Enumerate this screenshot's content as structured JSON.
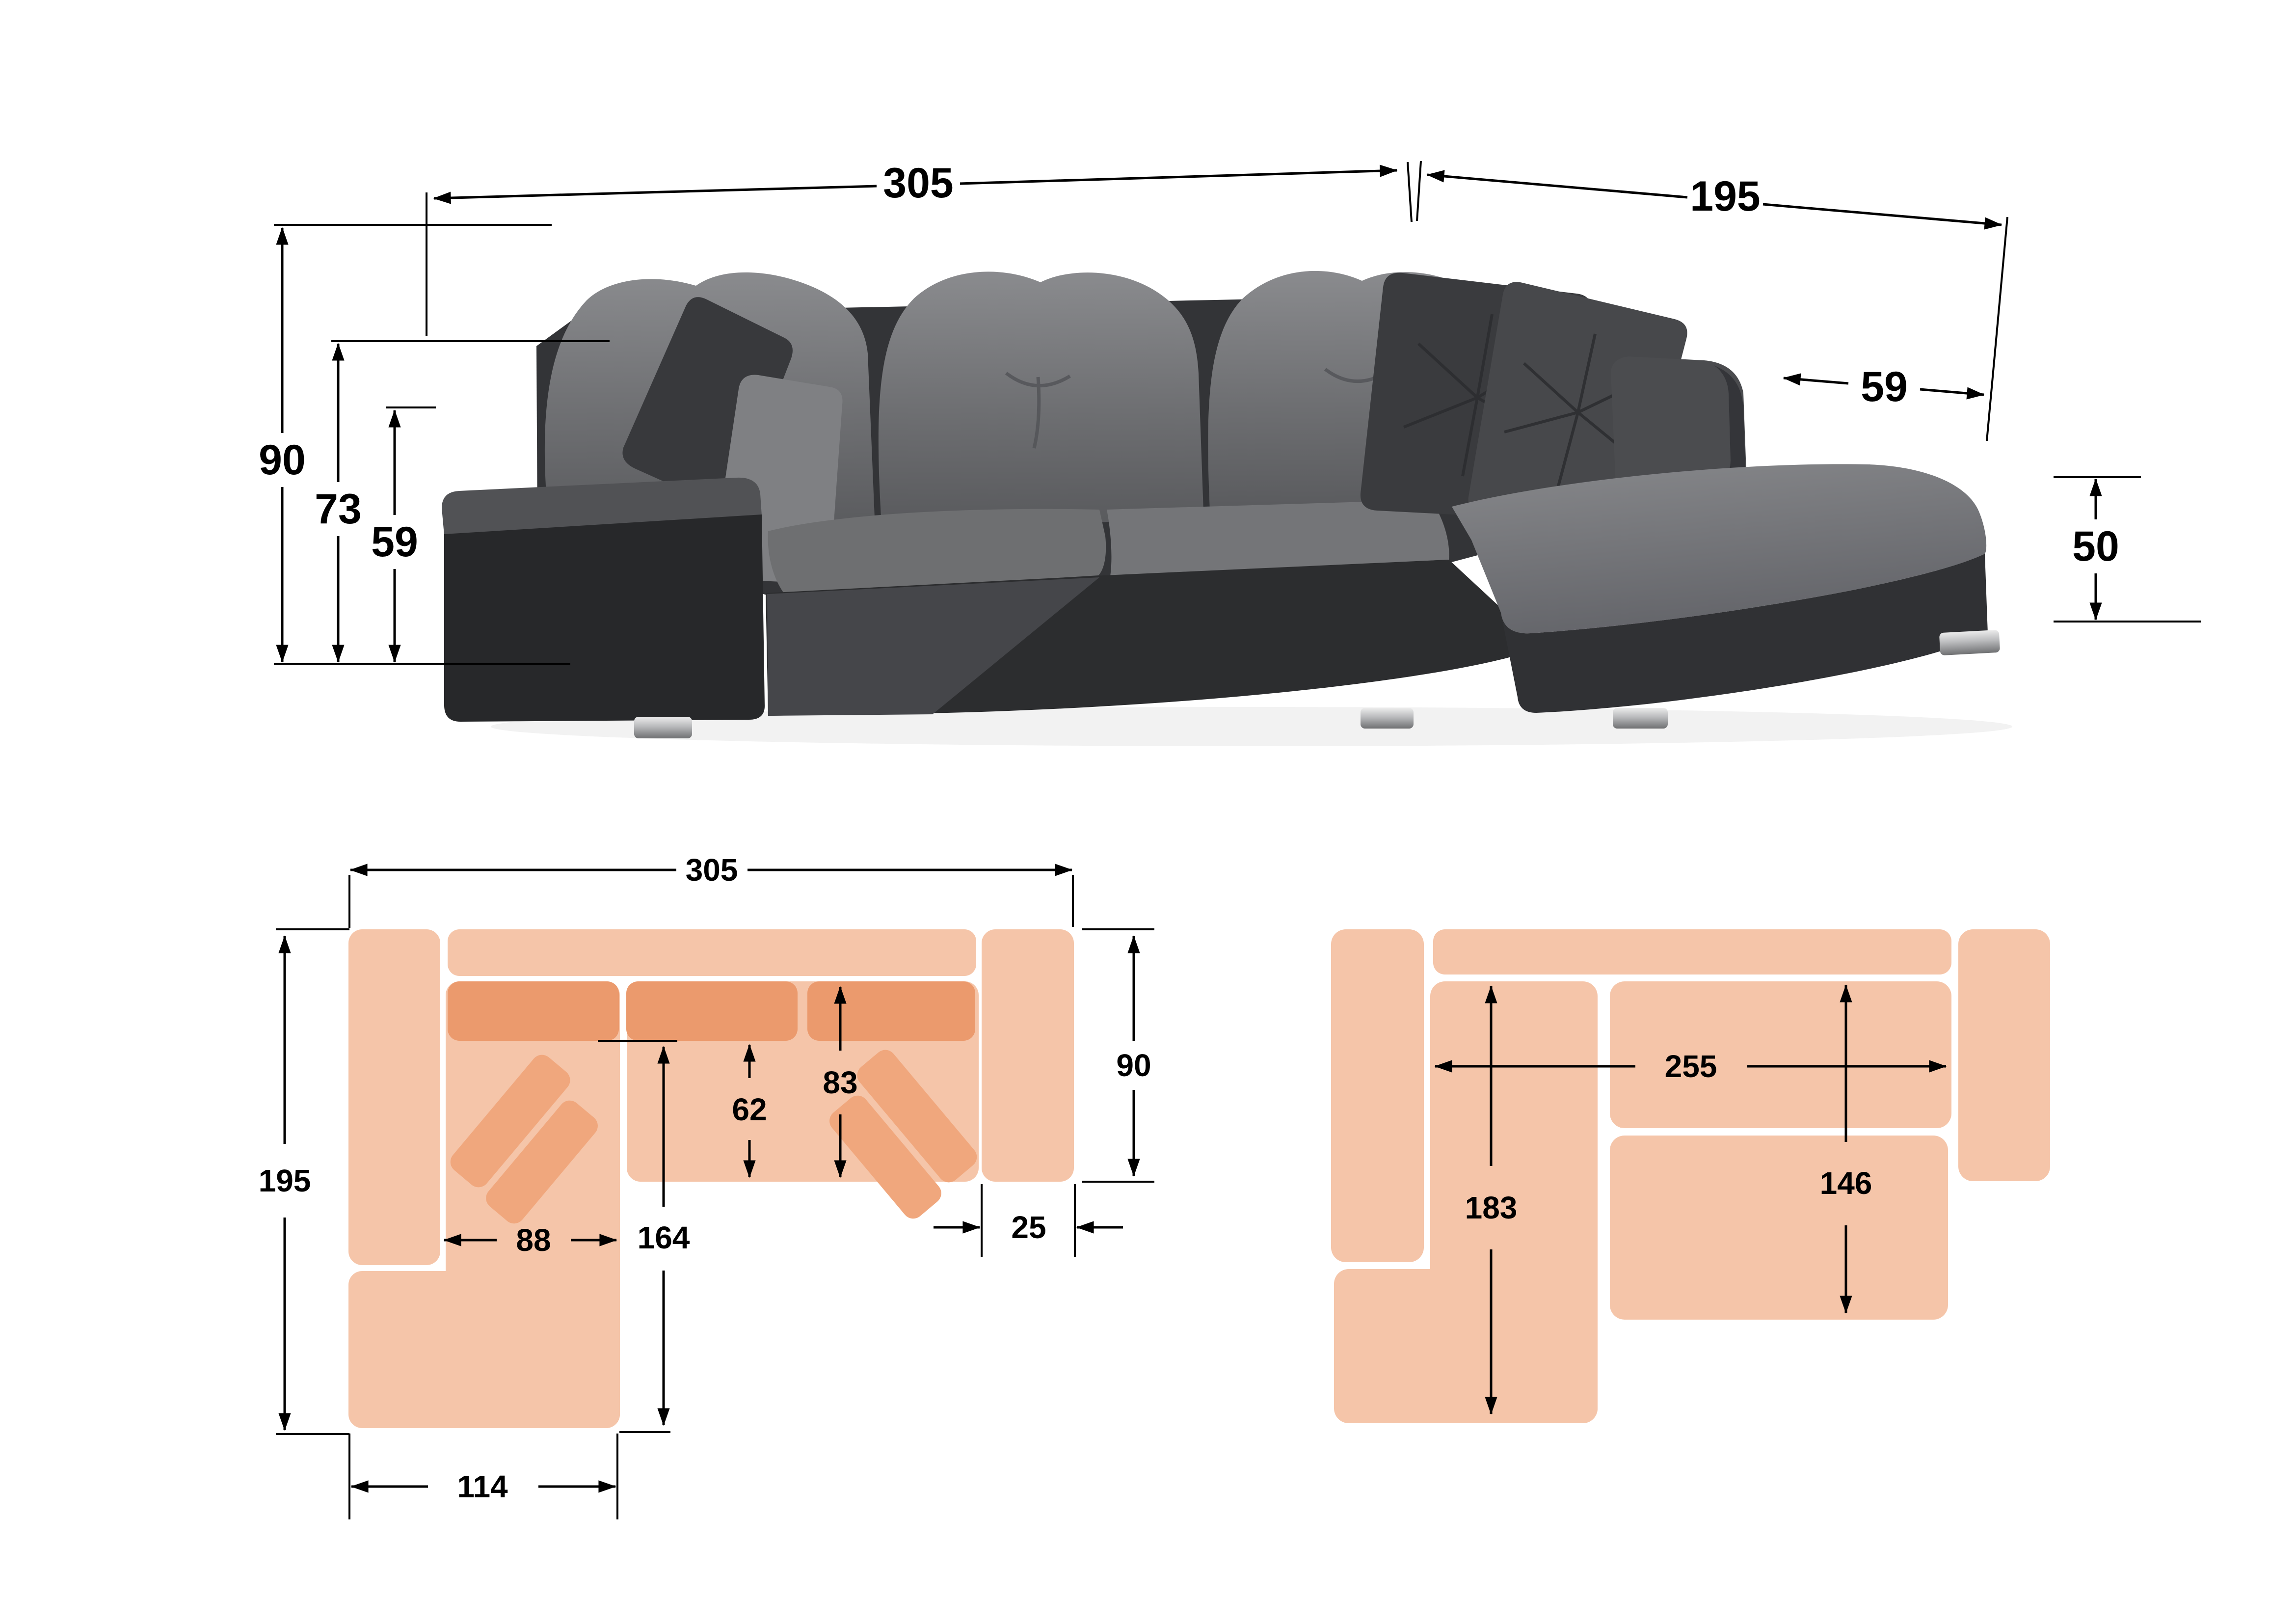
{
  "title": "Corner sofa with chaise — dimensions diagram",
  "colors": {
    "background": "#FFFFFF",
    "peach_light": "#F5C5A9",
    "peach_mid": "#F0A77D",
    "peach_dark": "#EB9A6D",
    "line": "#000000"
  },
  "side_view": {
    "width": "305",
    "depth": "195",
    "height": "90",
    "backrest_height": "73",
    "seat_height": "59",
    "armrest_depth": "59",
    "chaise_height": "50"
  },
  "top_view": {
    "width": "305",
    "depth": "195",
    "right_section_depth": "90",
    "chaise_inner_width": "88",
    "chaise_length": "164",
    "chaise_width": "114",
    "seat_depth": "62",
    "seat_depth_with_back": "83",
    "armrest_width": "25"
  },
  "bed_view": {
    "bed_width": "255",
    "bed_length_left": "183",
    "bed_width_right": "146"
  }
}
